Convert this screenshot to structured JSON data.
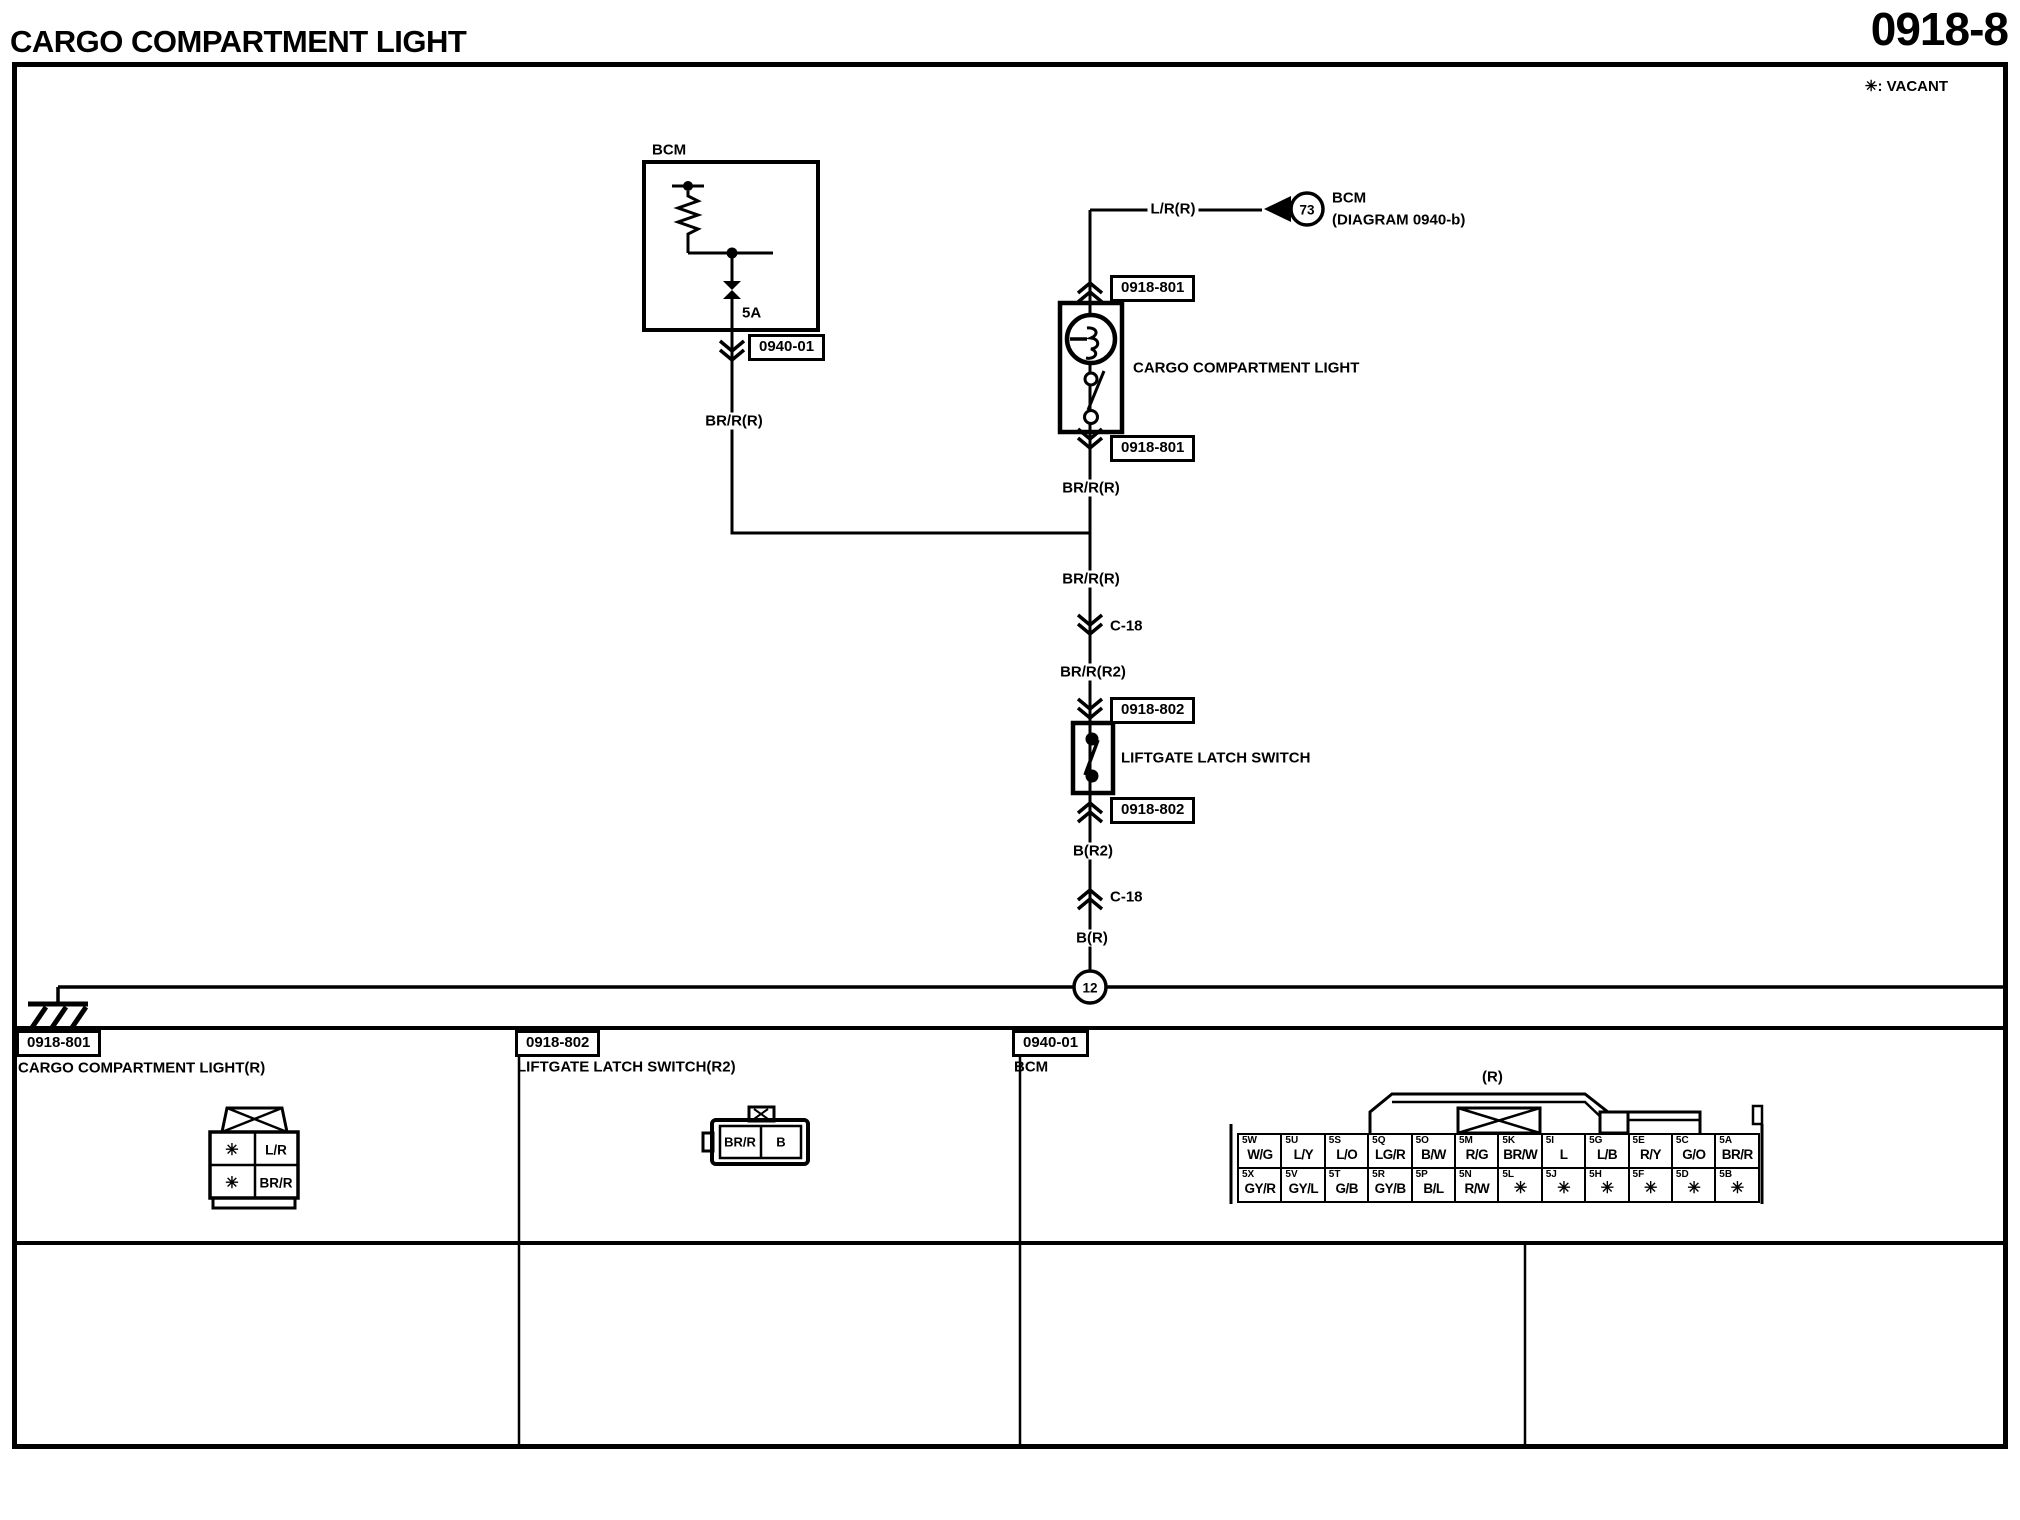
{
  "page": {
    "title": "CARGO COMPARTMENT LIGHT",
    "number": "0918-8",
    "vacant_note": "✳: VACANT"
  },
  "schematic": {
    "bcm": {
      "label": "BCM",
      "fuse_rating": "5A",
      "connector_ref": "0940-01"
    },
    "offpage": {
      "wire": "L/R(R)",
      "circle_number": "73",
      "target": "BCM",
      "target_diagram": "(DIAGRAM 0940-b)"
    },
    "cargo_light": {
      "connector_ref": "0918-801",
      "label": "CARGO COMPARTMENT LIGHT"
    },
    "liftgate_switch": {
      "connector_ref": "0918-802",
      "label": "LIFTGATE LATCH SWITCH"
    },
    "wires": {
      "branch_left": "BR/R(R)",
      "below_light": "BR/R(R)",
      "below_junction": "BR/R(R)",
      "inline_connector_upper": "C-18",
      "to_switch": "BR/R(R2)",
      "below_switch": "B(R2)",
      "inline_connector_lower": "C-18",
      "to_ground": "B(R)"
    },
    "ground": {
      "circle_number": "12"
    }
  },
  "connector_details": {
    "c0918_801": {
      "ref": "0918-801",
      "name": "CARGO COMPARTMENT LIGHT(R)",
      "cells": {
        "r1c1": "✳",
        "r1c2": "L/R",
        "r2c1": "✳",
        "r2c2": "BR/R"
      }
    },
    "c0918_802": {
      "ref": "0918-802",
      "name": "LIFTGATE LATCH SWITCH(R2)",
      "cells": {
        "left": "BR/R",
        "right": "B"
      }
    },
    "c0940_01": {
      "ref": "0940-01",
      "name": "BCM",
      "variant": "(R)",
      "row1": [
        {
          "pin": "5W",
          "wire": "W/G"
        },
        {
          "pin": "5U",
          "wire": "L/Y"
        },
        {
          "pin": "5S",
          "wire": "L/O"
        },
        {
          "pin": "5Q",
          "wire": "LG/R"
        },
        {
          "pin": "5O",
          "wire": "B/W"
        },
        {
          "pin": "5M",
          "wire": "R/G"
        },
        {
          "pin": "5K",
          "wire": "BR/W"
        },
        {
          "pin": "5I",
          "wire": "L"
        },
        {
          "pin": "5G",
          "wire": "L/B"
        },
        {
          "pin": "5E",
          "wire": "R/Y"
        },
        {
          "pin": "5C",
          "wire": "G/O"
        },
        {
          "pin": "5A",
          "wire": "BR/R"
        }
      ],
      "row2": [
        {
          "pin": "5X",
          "wire": "GY/R"
        },
        {
          "pin": "5V",
          "wire": "GY/L"
        },
        {
          "pin": "5T",
          "wire": "G/B"
        },
        {
          "pin": "5R",
          "wire": "GY/B"
        },
        {
          "pin": "5P",
          "wire": "B/L"
        },
        {
          "pin": "5N",
          "wire": "R/W"
        },
        {
          "pin": "5L",
          "wire": "✳"
        },
        {
          "pin": "5J",
          "wire": "✳"
        },
        {
          "pin": "5H",
          "wire": "✳"
        },
        {
          "pin": "5F",
          "wire": "✳"
        },
        {
          "pin": "5D",
          "wire": "✳"
        },
        {
          "pin": "5B",
          "wire": "✳"
        }
      ]
    }
  }
}
